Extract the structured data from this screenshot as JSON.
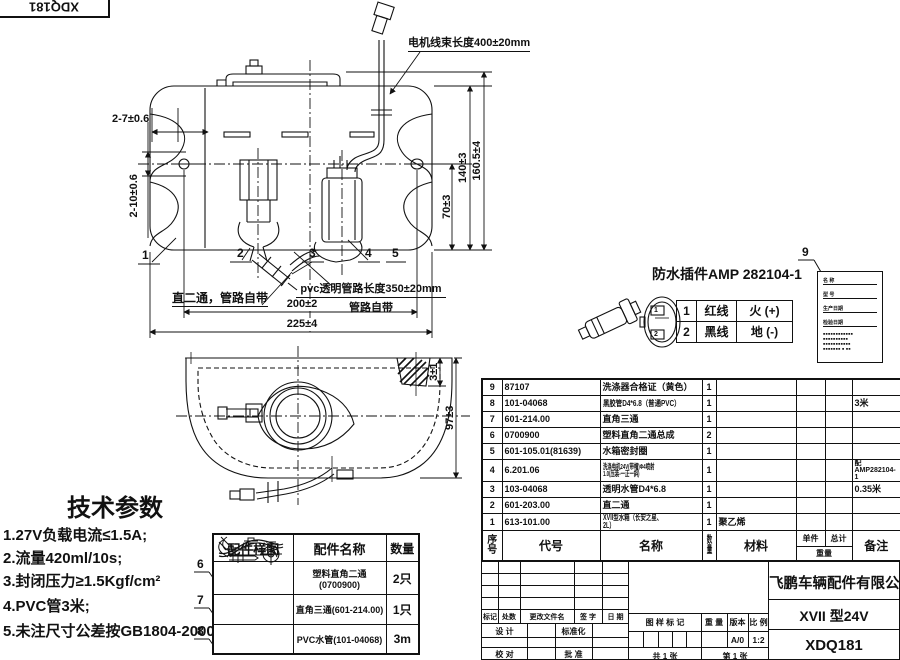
{
  "frame": {
    "drawing_no": "XDQ181"
  },
  "front_view": {
    "harness_label": "电机线束长度400±20mm",
    "note_straight": "直二通，管路自带",
    "note_pvc_1": "pvc透明管路长度350±20mm",
    "note_pvc_2": "管路自带",
    "dims": {
      "ear_hole_w": "2-7±0.6",
      "ear_hole_h": "2-10±0.6",
      "pump_h": "70±3",
      "body_h": "140±3",
      "total_h": "160.5±4",
      "hole_span": "200±2",
      "total_w": "225±4"
    },
    "balloons": [
      "1",
      "2",
      "3",
      "4",
      "5"
    ]
  },
  "top_view": {
    "dims": {
      "lip": "3±1",
      "depth": "97±3"
    }
  },
  "connector": {
    "title": "防水插件AMP 282104-1",
    "pins": [
      {
        "no": "1",
        "wire": "红线",
        "polarity": "火 (+)"
      },
      {
        "no": "2",
        "wire": "黑线",
        "polarity": "地 (-)"
      }
    ]
  },
  "certificate": {
    "balloon": "9",
    "fields": [
      "名 称",
      "型 号",
      "生产日期",
      "检验日期"
    ],
    "note_lines": [
      "■■■■■■■■■■■■",
      "■■■■■■■■■■",
      "■■■■■■■■■■■",
      "■■■■■■■ ■ ■■"
    ]
  },
  "bom": {
    "header": {
      "seq": "序号",
      "code": "代号",
      "name": "名称",
      "qty": "数量",
      "material": "材料",
      "unit": "单件",
      "total": "总计",
      "weight": "重量",
      "remark": "备注"
    },
    "rows": [
      {
        "seq": "9",
        "code": "87107",
        "name": "洗涤器合格证（黄色）",
        "qty": "1",
        "material": "",
        "remark": ""
      },
      {
        "seq": "8",
        "code": "101-04068",
        "name": "黑胶管D4*6.8（普通PVC）",
        "qty": "1",
        "material": "",
        "remark": "3米"
      },
      {
        "seq": "7",
        "code": "601-214.00",
        "name": "直角三通",
        "qty": "1",
        "material": "",
        "remark": ""
      },
      {
        "seq": "6",
        "code": "0700900",
        "name": "塑料直角二通总成",
        "qty": "2",
        "material": "",
        "remark": ""
      },
      {
        "seq": "5",
        "code": "601-105.01(81639)",
        "name": "水箱密封圈",
        "qty": "1",
        "material": "",
        "remark": ""
      },
      {
        "seq": "4",
        "code": "6.201.06",
        "name": "洗涤电机24V(带帽)Φ4喷射1.0(压装-一正一斜)",
        "qty": "1",
        "material": "",
        "remark": "配AMP282104-1"
      },
      {
        "seq": "3",
        "code": "103-04068",
        "name": "透明水管D4*6.8",
        "qty": "1",
        "material": "",
        "remark": "0.35米"
      },
      {
        "seq": "2",
        "code": "601-203.00",
        "name": "直二通",
        "qty": "1",
        "material": "",
        "remark": ""
      },
      {
        "seq": "1",
        "code": "613-101.00",
        "name": "XVII型水箱（长安之星、2L）",
        "qty": "1",
        "material": "聚乙烯",
        "remark": ""
      }
    ]
  },
  "tech_params": {
    "title": "技术参数",
    "items": [
      "1.27V负载电流≤1.5A;",
      "2.流量420ml/10s;",
      "3.封闭压力≥1.5Kgf/cm²",
      "4.PVC管3米;",
      "5.未注尺寸公差按GB1804-2000。"
    ]
  },
  "accessories": {
    "headers": {
      "sample": "配件样图",
      "name": "配件名称",
      "qty": "数量"
    },
    "rows": [
      {
        "balloon": "6",
        "name": "塑料直角二通(0700900)",
        "qty": "2只"
      },
      {
        "balloon": "7",
        "name": "直角三通(601-214.00)",
        "qty": "1只"
      },
      {
        "balloon": "8",
        "name": "PVC水管(101-04068)",
        "qty": "3m"
      }
    ]
  },
  "title_block": {
    "company": "飞鹏车辆配件有限公司",
    "model": "XVII 型24V",
    "drawing_no": "XDQ181",
    "rev_cols": [
      "标记",
      "处数",
      "更改文件名",
      "签 字",
      "日 期"
    ],
    "sign_rows": {
      "design": "设 计",
      "standard": "标准化",
      "check": "校 对",
      "approve": "批 准",
      "audit": "审 核",
      "date": "日 期"
    },
    "stamp": {
      "mark": "图 样 标 记",
      "weight": "重 量",
      "version": "版本",
      "scale": "比 例",
      "version_val": "A/0",
      "scale_val": "1:2",
      "sheet_total": "共 1 张",
      "sheet_no": "第 1 张"
    }
  }
}
